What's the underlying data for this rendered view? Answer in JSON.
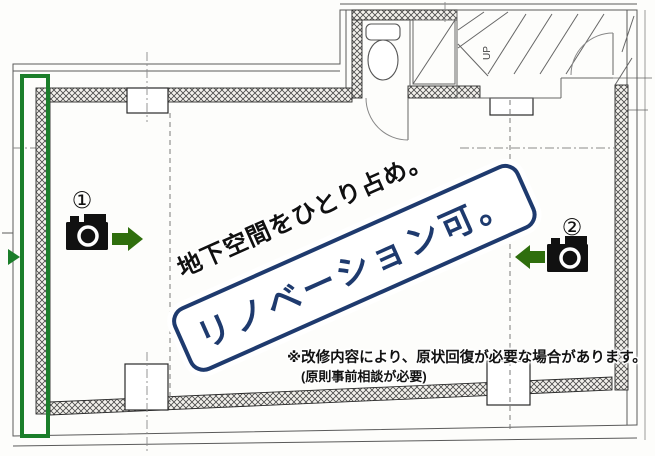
{
  "page": {
    "type": "basement-floorplan-flyer"
  },
  "headline": {
    "sub": "地下空間をひとり占め。",
    "main": "リノベーション可。"
  },
  "disclaimer": {
    "line1": "※改修内容により、原状回復が必要な場合があります。",
    "line2": "(原則事前相談が必要)"
  },
  "plan": {
    "camera1_label": "①",
    "camera2_label": "②",
    "stairs_label": "UP"
  },
  "icons": {
    "camera_1": "camera-icon",
    "camera_1_arrow": "arrow-right-icon",
    "camera_2": "camera-icon",
    "camera_2_arrow": "arrow-left-icon",
    "toilet": "toilet-plan-icon",
    "stairs": "stairs-plan-icon"
  },
  "colors": {
    "marker_green": "#1b7e2a",
    "arrow_green": "#2f6e0d",
    "headline_navy": "#1e3a6e",
    "text_black": "#111111",
    "plan_line_gray": "#5a5a5a"
  }
}
